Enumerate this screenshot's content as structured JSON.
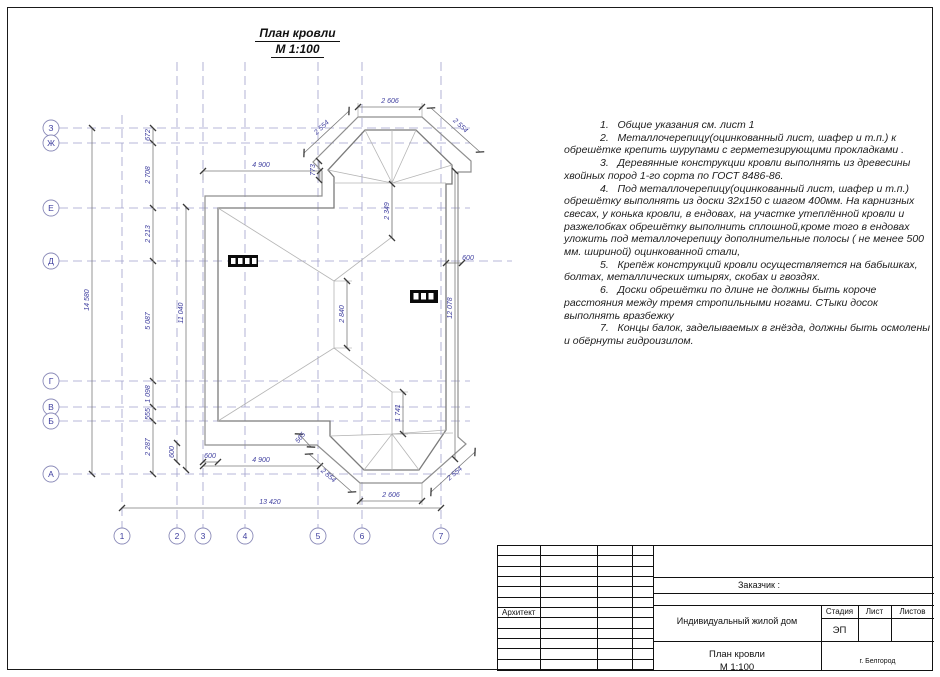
{
  "sheet": {
    "title_line1": "План кровли",
    "title_line2": "М 1:100"
  },
  "notes": [
    "1.   Общие указания см. лист 1",
    "2.   Металлочерепицу(оцинкованный лист, шафер и т.п.) к обрешётке крепить шурупами с герметезирующими прокладками .",
    "3.   Деревянные конструкции кровли выполнять из древесины хвойных пород 1-го сорта по ГОСТ 8486-86.",
    "4.   Под  металлочерепицу(оцинкованный лист, шафер и т.п.) обрешётку выполнять из доски 32x150 с шагом 400мм. На карнизных свесах, у конька кровли, в ендовах, на участке утеплённой кровли и разжелобках обрешётку выполнить сплошной,кроме того в ендовах уложить под металлочерепицу дополнительные полосы ( не менее 500 мм. шириной) оцинкованной стали,",
    "5.   Крепёж конструкций кровли осуществляется на бабышках, болтах, металлических штырях, скобах и гвоздях.",
    "6.   Доски обрешётки по длине не должны быть короче расстояния между тремя стропильными ногами. СТыки досок выполнять вразбежку",
    "7.   Концы балок, заделываемых в гнёзда, должны быть осмолены и обёрнуты гидроизилом."
  ],
  "plan": {
    "axes_left": [
      "З",
      "Ж",
      "Е",
      "Д",
      "Г",
      "В",
      "Б",
      "А"
    ],
    "axes_bottom": [
      "1",
      "2",
      "3",
      "4",
      "5",
      "6",
      "7"
    ],
    "dims": {
      "overall_v": "14 580",
      "seg_672": "672",
      "seg_2708": "2 708",
      "seg_2213": "2 213",
      "seg_5087": "5 087",
      "seg_1098": "1 098",
      "seg_555": "555",
      "seg_2287": "2 287",
      "wall_11040": "11 040",
      "top_4900": "4 900",
      "top_773": "773",
      "top_bay_width": "2 606",
      "top_bay_left": "2 554",
      "top_bay_right": "2 554",
      "top_valley_2349": "2 349",
      "right_600": "600",
      "right_12078": "12 078",
      "ridge_2840": "2 840",
      "bot_valley_1741": "1 741",
      "bot_565": "565",
      "bot_600v": "600",
      "bot_600h": "600",
      "bot_4900": "4 900",
      "bot_bay_width": "2 606",
      "bot_bay_left": "2 554",
      "bot_bay_right": "2 554",
      "overall_h": "13 420"
    },
    "colors": {
      "dim_text": "#3f3f9f",
      "axis_line": "#a0a0cc",
      "outline": "#828282"
    }
  },
  "titleblock": {
    "customer": "Заказчик :",
    "architect": "Архитект",
    "project": "Индивидуальный жилой дом",
    "stage_label": "Стадия",
    "sheet_label": "Лист",
    "sheets_label": "Листов",
    "stage_value": "ЭП",
    "drawing_name1": "План кровли",
    "drawing_name2": "М 1:100",
    "city": "г. Белгород"
  }
}
